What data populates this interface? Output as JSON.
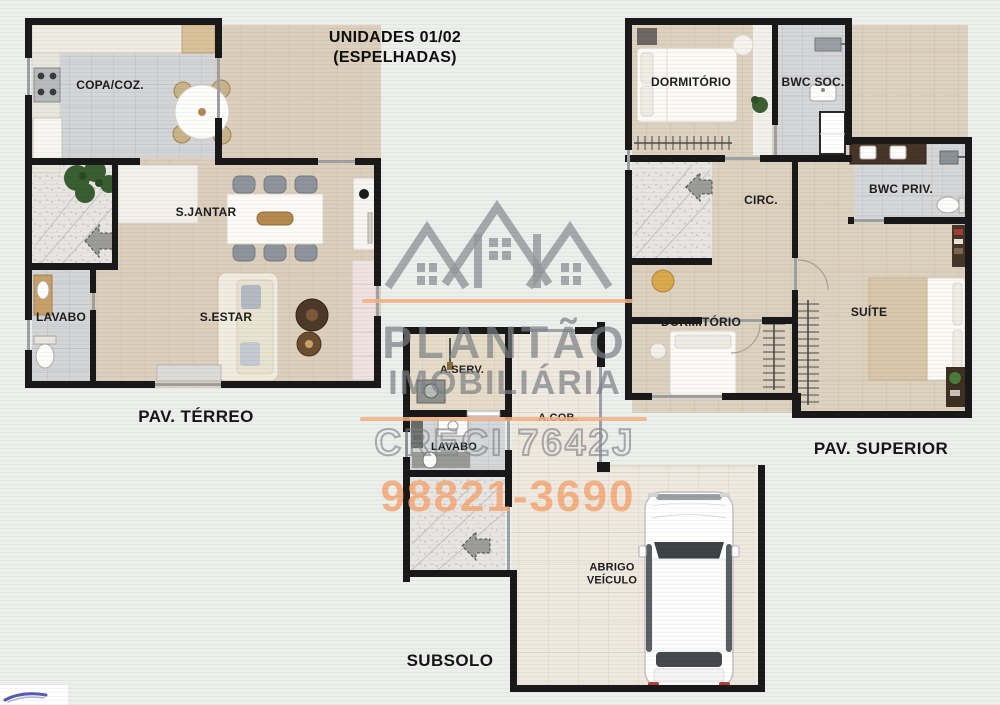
{
  "title": {
    "line1": "UNIDADES 01/02",
    "line2": "(ESPELHADAS)"
  },
  "watermark": {
    "brand_top": "PLANTÃO",
    "brand_bottom": "IMOBILIÁRIA",
    "license": "CRECI 7642J",
    "phone": "98821-3690",
    "logo": "three-house-roofs-icon"
  },
  "floors": {
    "terreo": {
      "caption": "PAV. TÉRREO",
      "rooms": {
        "copa_coz": "COPA/COZ.",
        "s_jantar": "S.JANTAR",
        "lavabo": "LAVABO",
        "s_estar": "S.ESTAR"
      }
    },
    "superior": {
      "caption": "PAV. SUPERIOR",
      "rooms": {
        "dormitorio_1": "DORMITÓRIO",
        "bwc_soc": "BWC SOC.",
        "circ": "CIRC.",
        "bwc_priv": "BWC PRIV.",
        "dormitorio_2": "DORMITÓRIO",
        "suite": "SUÍTE"
      }
    },
    "subsolo": {
      "caption": "SUBSOLO",
      "rooms": {
        "a_serv": "A.SERV.",
        "lavabo": "LAVABO",
        "a_cob": "A.COB.",
        "abrigo_veiculo": "ABRIGO\nVEÍCULO"
      }
    }
  },
  "colors": {
    "wall": "#191919",
    "floor_wood": "#dccfbc",
    "floor_tile": "#d4d5d7",
    "floor_big_tile": "#efe9e0",
    "watermark_gray": "#7c8085",
    "watermark_orange": "#f3b284",
    "phone_orange": "#f3a775",
    "logo_blue": "#3b3f9e"
  }
}
